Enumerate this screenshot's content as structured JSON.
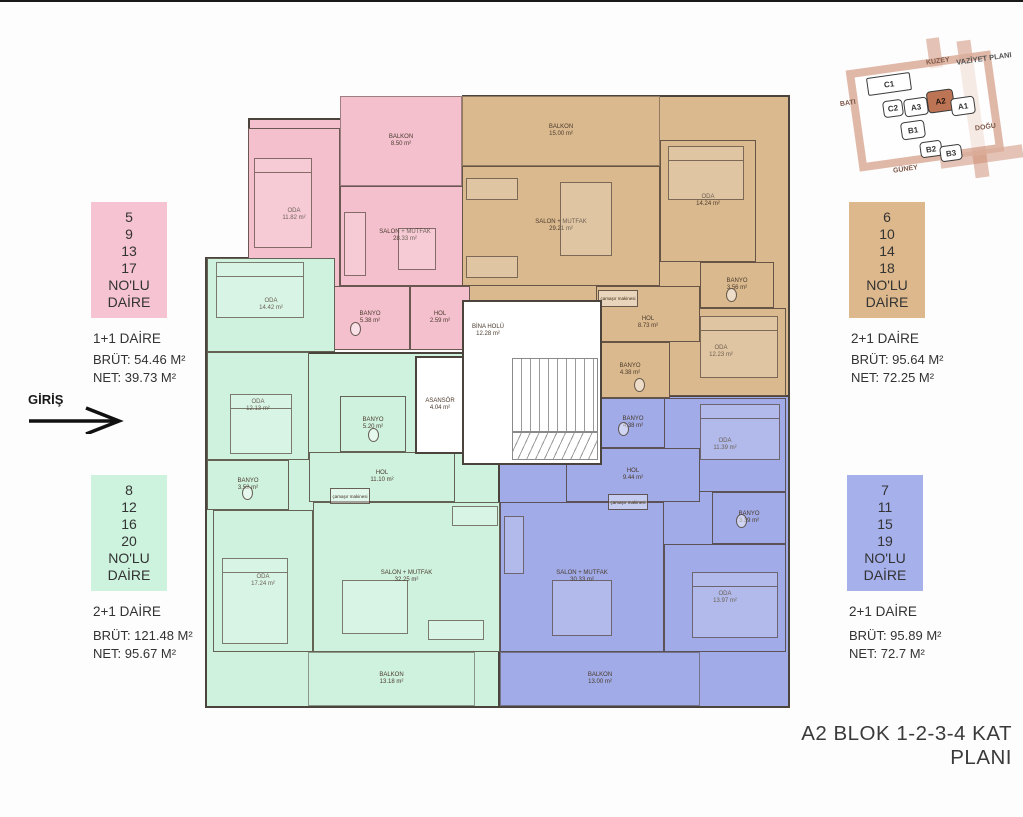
{
  "floor_plan_title": "A2 BLOK 1-2-3-4 KAT PLANI",
  "entrance": {
    "label": "GİRİŞ"
  },
  "site_plan": {
    "title": "VAZİYET PLANI",
    "directions": {
      "north": "KUZEY",
      "south": "GÜNEY",
      "east": "DOĞU",
      "west": "BATI"
    },
    "blocks": [
      {
        "label": "C1"
      },
      {
        "label": "C2"
      },
      {
        "label": "A3"
      },
      {
        "label": "A2",
        "highlighted": true
      },
      {
        "label": "A1"
      },
      {
        "label": "B1"
      },
      {
        "label": "B2"
      },
      {
        "label": "B3"
      }
    ],
    "highlighted_block": "A2",
    "highlight_color": "#bd7454"
  },
  "common_areas": {
    "elevator": {
      "name": "ASANSÖR",
      "area": "4.04 m²"
    },
    "building_hall": {
      "name": "BİNA HOLÜ",
      "area": "12.28 m²"
    }
  },
  "apartments": [
    {
      "id": "pink",
      "color": "#f4c0ce",
      "box_lines": [
        "5",
        "9",
        "13",
        "17",
        "NO'LU",
        "DAİRE"
      ],
      "type_label": "1+1 DAİRE",
      "brut_label": "BRÜT: 54.46 M²",
      "net_label": "NET: 39.73 M²",
      "rooms": [
        {
          "name": "BALKON",
          "area": "8.50 m²"
        },
        {
          "name": "ODA",
          "area": "11.82 m²"
        },
        {
          "name": "SALON + MUTFAK",
          "area": "28.33 m²"
        },
        {
          "name": "BANYO",
          "area": "5.38 m²"
        },
        {
          "name": "HOL",
          "area": "2.59 m²"
        }
      ]
    },
    {
      "id": "tan",
      "color": "#dab98e",
      "box_lines": [
        "6",
        "10",
        "14",
        "18",
        "NO'LU",
        "DAİRE"
      ],
      "type_label": "2+1 DAİRE",
      "brut_label": "BRÜT: 95.64 M²",
      "net_label": "NET: 72.25 M²",
      "rooms": [
        {
          "name": "BALKON",
          "area": "15.00 m²"
        },
        {
          "name": "SALON + MUTFAK",
          "area": "29.21 m²"
        },
        {
          "name": "ODA",
          "area": "14.24 m²"
        },
        {
          "name": "BANYO",
          "area": "3.56 m²"
        },
        {
          "name": "ODA",
          "area": "12.23 m²"
        },
        {
          "name": "HOL",
          "area": "8.73 m²"
        },
        {
          "name": "BANYO",
          "area": "4.38 m²"
        },
        {
          "name": "çamaşır makinesi",
          "area": ""
        }
      ]
    },
    {
      "id": "green",
      "color": "#cff2df",
      "box_lines": [
        "8",
        "12",
        "16",
        "20",
        "NO'LU",
        "DAİRE"
      ],
      "type_label": "2+1 DAİRE",
      "brut_label": "BRÜT: 121.48 M²",
      "net_label": "NET: 95.67 M²",
      "rooms": [
        {
          "name": "ODA",
          "area": "14.42 m²"
        },
        {
          "name": "ODA",
          "area": "12.13 m²"
        },
        {
          "name": "BANYO",
          "area": "5.20 m²"
        },
        {
          "name": "HOL",
          "area": "11.10 m²"
        },
        {
          "name": "BANYO",
          "area": "3.52 m²"
        },
        {
          "name": "ODA",
          "area": "17.24 m²"
        },
        {
          "name": "SALON + MUTFAK",
          "area": "32.25 m²"
        },
        {
          "name": "BALKON",
          "area": "13.18 m²"
        },
        {
          "name": "çamaşır makinesi",
          "area": ""
        }
      ]
    },
    {
      "id": "blue",
      "color": "#a0abe7",
      "box_lines": [
        "7",
        "11",
        "15",
        "19",
        "NO'LU",
        "DAİRE"
      ],
      "type_label": "2+1 DAİRE",
      "brut_label": "BRÜT: 95.89 M²",
      "net_label": "NET: 72.7 M²",
      "rooms": [
        {
          "name": "BANYO",
          "area": "4.38 m²"
        },
        {
          "name": "ODA",
          "area": "11.39 m²"
        },
        {
          "name": "HOL",
          "area": "9.44 m²"
        },
        {
          "name": "BANYO",
          "area": "3.39 m²"
        },
        {
          "name": "ODA",
          "area": "13.97 m²"
        },
        {
          "name": "SALON + MUTFAK",
          "area": "30.33 m²"
        },
        {
          "name": "BALKON",
          "area": "13.00 m²"
        },
        {
          "name": "çamaşır makinesi",
          "area": ""
        }
      ]
    }
  ]
}
